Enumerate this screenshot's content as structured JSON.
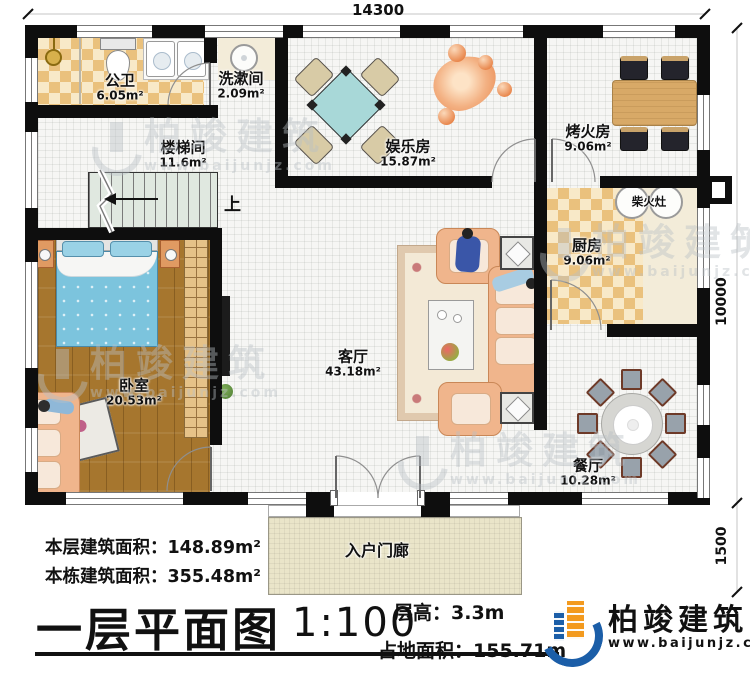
{
  "dimensions": {
    "top": "14300",
    "right_upper": "10000",
    "right_lower": "1500"
  },
  "stairs": {
    "up_label": "上"
  },
  "rooms": {
    "public_bath": {
      "name": "公卫",
      "area": "6.05m²"
    },
    "washroom": {
      "name": "洗漱间",
      "area": "2.09m²"
    },
    "stair_hall": {
      "name": "楼梯间",
      "area": "11.6m²"
    },
    "recreation": {
      "name": "娱乐房",
      "area": "15.87m²"
    },
    "fire_room": {
      "name": "烤火房",
      "area": "9.06m²"
    },
    "kitchen": {
      "name": "厨房",
      "area": "9.06m²"
    },
    "wood_stove": {
      "name": "柴火灶"
    },
    "bedroom": {
      "name": "卧室",
      "area": "20.53m²"
    },
    "living": {
      "name": "客厅",
      "area": "43.18m²"
    },
    "dining": {
      "name": "餐厅",
      "area": "10.28m²"
    },
    "porch": {
      "name": "入户门廊"
    }
  },
  "footer": {
    "floor_area_label": "本层建筑面积：",
    "floor_area_value": "148.89m²",
    "total_area_label": "本栋建筑面积：",
    "total_area_value": "355.48m²",
    "title": "一层平面图",
    "scale": "1:100",
    "height_label": "层高：",
    "height_value": "3.3m",
    "land_label": "占地面积：",
    "land_value": "155.71m"
  },
  "brand": {
    "name": "柏竣建筑",
    "site": "www.baijunjz.com",
    "brand_blue": "#1b5ea8",
    "brand_orange": "#f39a1e"
  },
  "watermark": {
    "name": "柏竣建筑",
    "site": "www.baijunjz.com"
  }
}
